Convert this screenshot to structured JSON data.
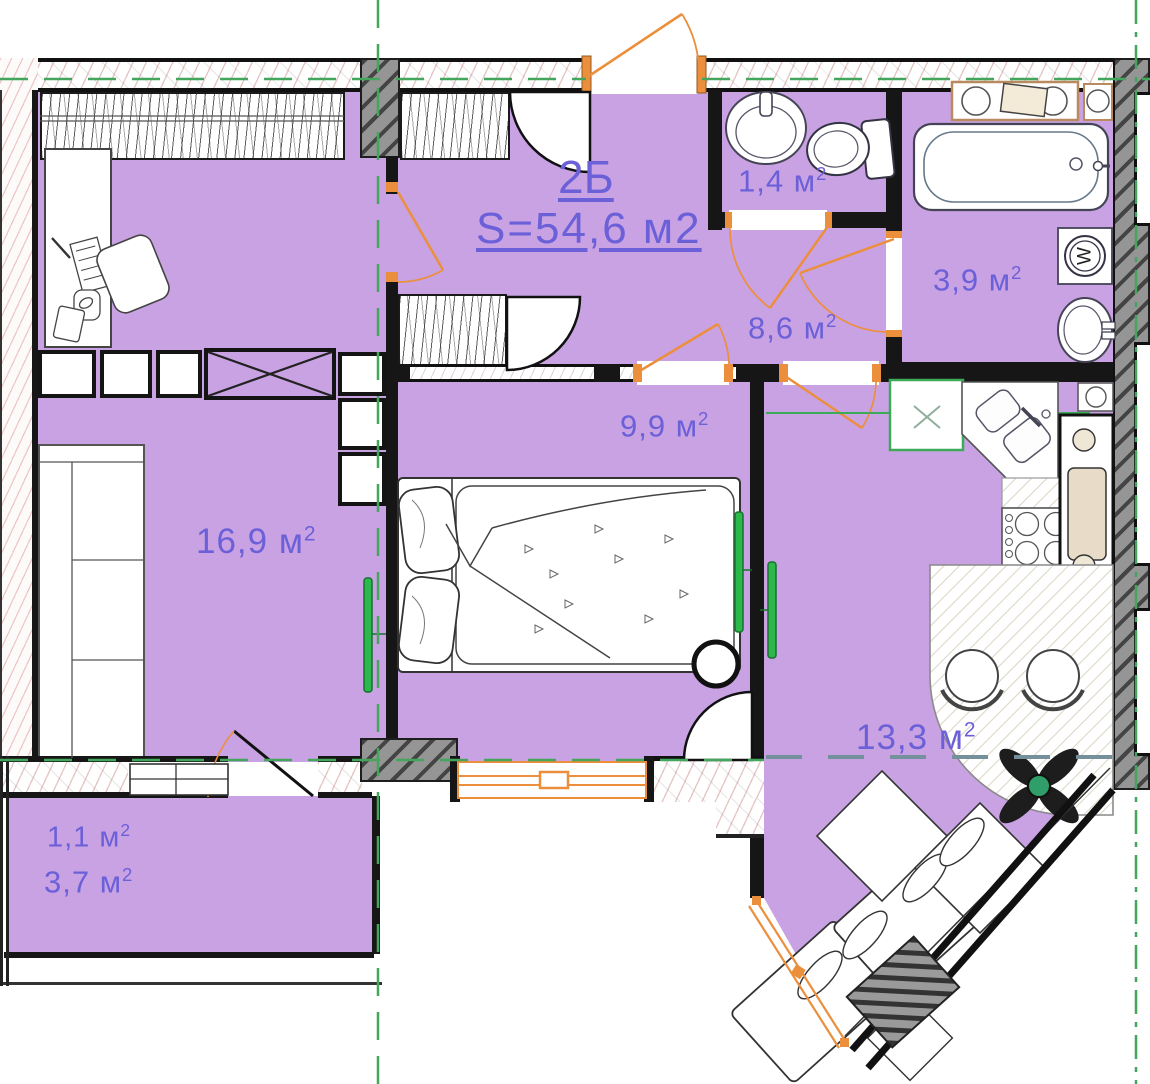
{
  "plan": {
    "title": "2Б",
    "total_area": "S=54,6 м2",
    "rooms": {
      "wc": {
        "label": "1,4 м",
        "sup": "2"
      },
      "bathroom": {
        "label": "3,9 м",
        "sup": "2"
      },
      "hallway": {
        "label": "8,6 м",
        "sup": "2"
      },
      "bedroom": {
        "label": "9,9 м",
        "sup": "2"
      },
      "living_room": {
        "label": "16,9 м",
        "sup": "2"
      },
      "kitchen": {
        "label": "13,3 м",
        "sup": "2"
      },
      "balcony_upper": {
        "label": "1,1 м",
        "sup": "2"
      },
      "balcony_lower": {
        "label": "3,7 м",
        "sup": "2"
      }
    },
    "appliances": {
      "washing_machine_letter": "W"
    },
    "colors": {
      "room_fill": "#c9a2e3",
      "label_text": "#6b60d8",
      "door_accent": "#ec8f3d",
      "axis_green": "#44a65c",
      "radiator_green": "#2db84d",
      "wall_black": "#161616"
    }
  }
}
